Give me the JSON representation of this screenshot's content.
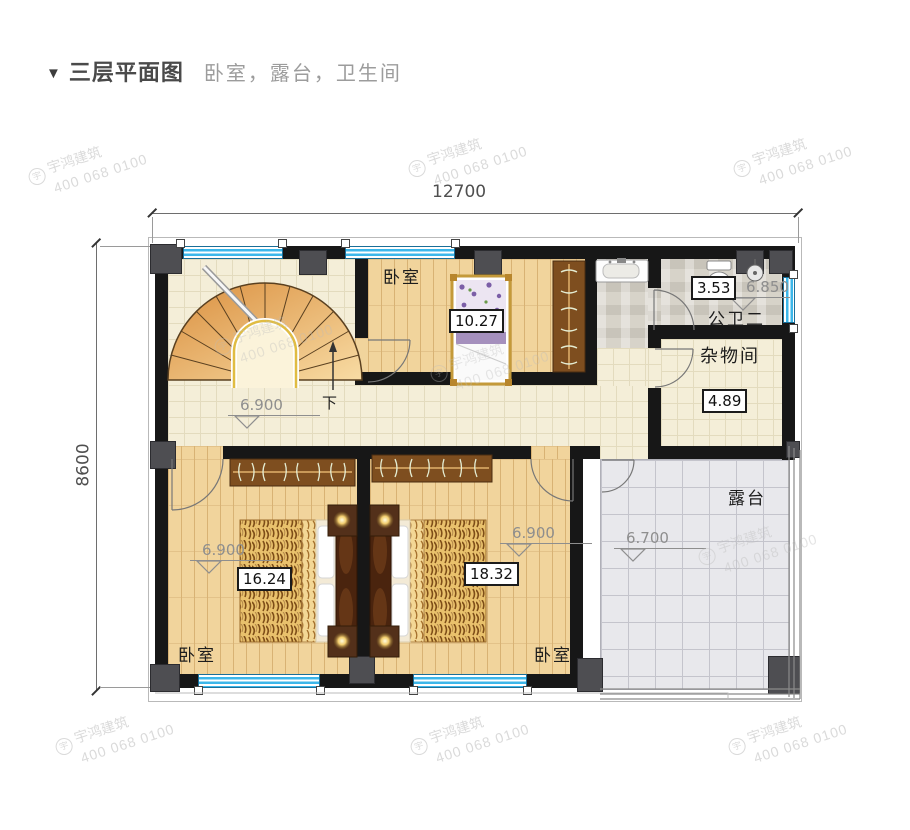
{
  "header": {
    "marker": "▼",
    "title": "三层平面图",
    "subtitle": "卧室，露台，卫生间"
  },
  "dimensions": {
    "width_top": "12700",
    "height_left": "8600"
  },
  "watermark": {
    "logo_char": "宇",
    "brand": "宇鸿建筑",
    "phone": "400 068 0100"
  },
  "rooms": {
    "stair_hall": {
      "level": "6.900",
      "stair_direction": "下"
    },
    "bedroom_top": {
      "name": "卧室",
      "area": "10.27"
    },
    "bathroom": {
      "name": "公卫二",
      "area": "3.53",
      "level": "6.850"
    },
    "storage": {
      "name": "杂物间",
      "area": "4.89"
    },
    "bedroom_sw": {
      "name": "卧室",
      "area": "16.24",
      "level": "6.900"
    },
    "bedroom_se": {
      "name": "卧室",
      "area": "18.32",
      "level": "6.900"
    },
    "terrace": {
      "name": "露台",
      "level": "6.700"
    }
  },
  "colors": {
    "wall": "#171717",
    "window_blue": "#3cb7ea",
    "stair_wood": "#e09a4c",
    "floor_wood": "#f1d49c",
    "floor_tile": "#f4eed8",
    "floor_stone": "#d7d3c9",
    "terrace": "#e8e8ec",
    "accent_yellow": "#e0bc42"
  }
}
